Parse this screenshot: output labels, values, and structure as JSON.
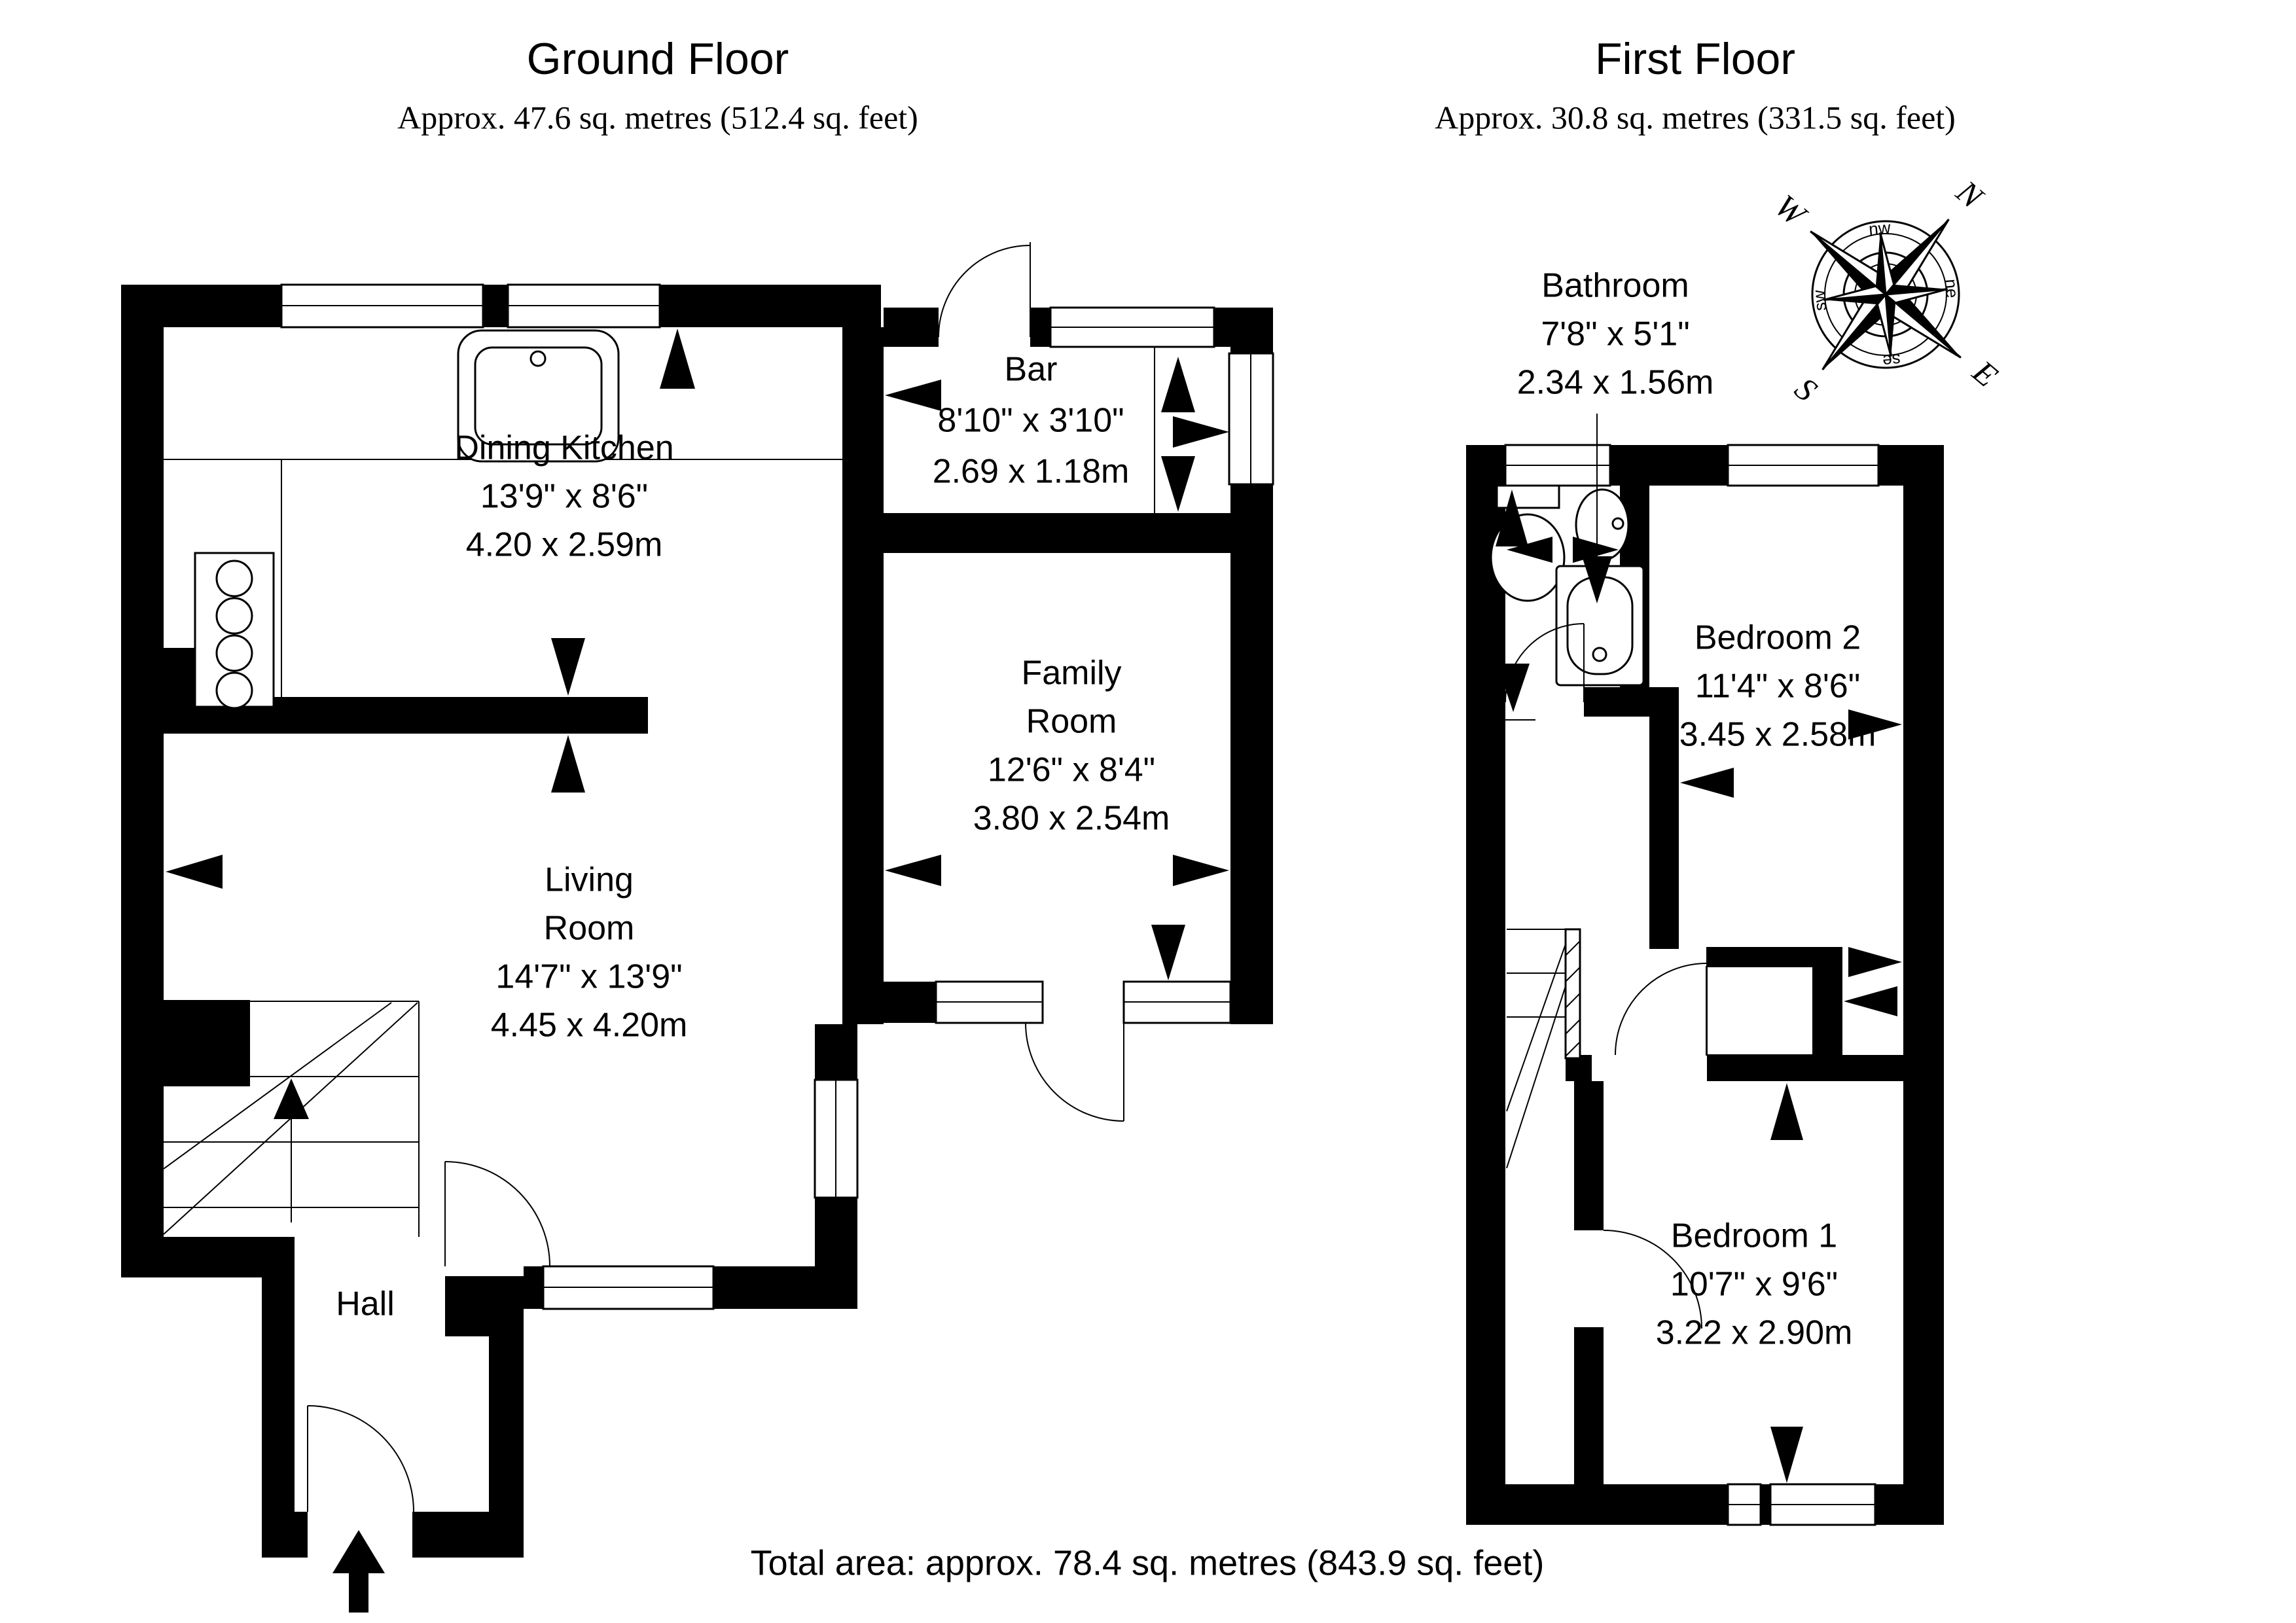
{
  "page": {
    "background": "#ffffff",
    "ink": "#000000"
  },
  "ground_floor": {
    "title": "Ground Floor",
    "area_line": "Approx. 47.6 sq. metres (512.4 sq. feet)",
    "rooms": {
      "dining_kitchen": {
        "name": "Dining Kitchen",
        "imperial": "13'9\" x 8'6\"",
        "metric": "4.20 x 2.59m"
      },
      "bar": {
        "name": "Bar",
        "imperial": "8'10\" x 3'10\"",
        "metric": "2.69 x 1.18m"
      },
      "family_room": {
        "name_line1": "Family",
        "name_line2": "Room",
        "imperial": "12'6\" x 8'4\"",
        "metric": "3.80 x 2.54m"
      },
      "living_room": {
        "name_line1": "Living",
        "name_line2": "Room",
        "imperial": "14'7\" x 13'9\"",
        "metric": "4.45 x 4.20m"
      },
      "hall": {
        "name": "Hall"
      }
    }
  },
  "first_floor": {
    "title": "First Floor",
    "area_line": "Approx. 30.8 sq. metres (331.5 sq. feet)",
    "rooms": {
      "bathroom": {
        "name": "Bathroom",
        "imperial": "7'8\" x 5'1\"",
        "metric": "2.34 x 1.56m"
      },
      "bedroom_2": {
        "name": "Bedroom 2",
        "imperial": "11'4\" x 8'6\"",
        "metric": "3.45 x 2.58m"
      },
      "bedroom_1": {
        "name": "Bedroom 1",
        "imperial": "10'7\" x 9'6\"",
        "metric": "3.22 x 2.90m"
      }
    }
  },
  "total_area_line": "Total area: approx. 78.4 sq. metres (843.9 sq. feet)",
  "compass": {
    "n": "N",
    "e": "E",
    "s": "S",
    "w": "W",
    "nw": "nw",
    "ne": "ne",
    "se": "se",
    "sw": "sw"
  }
}
